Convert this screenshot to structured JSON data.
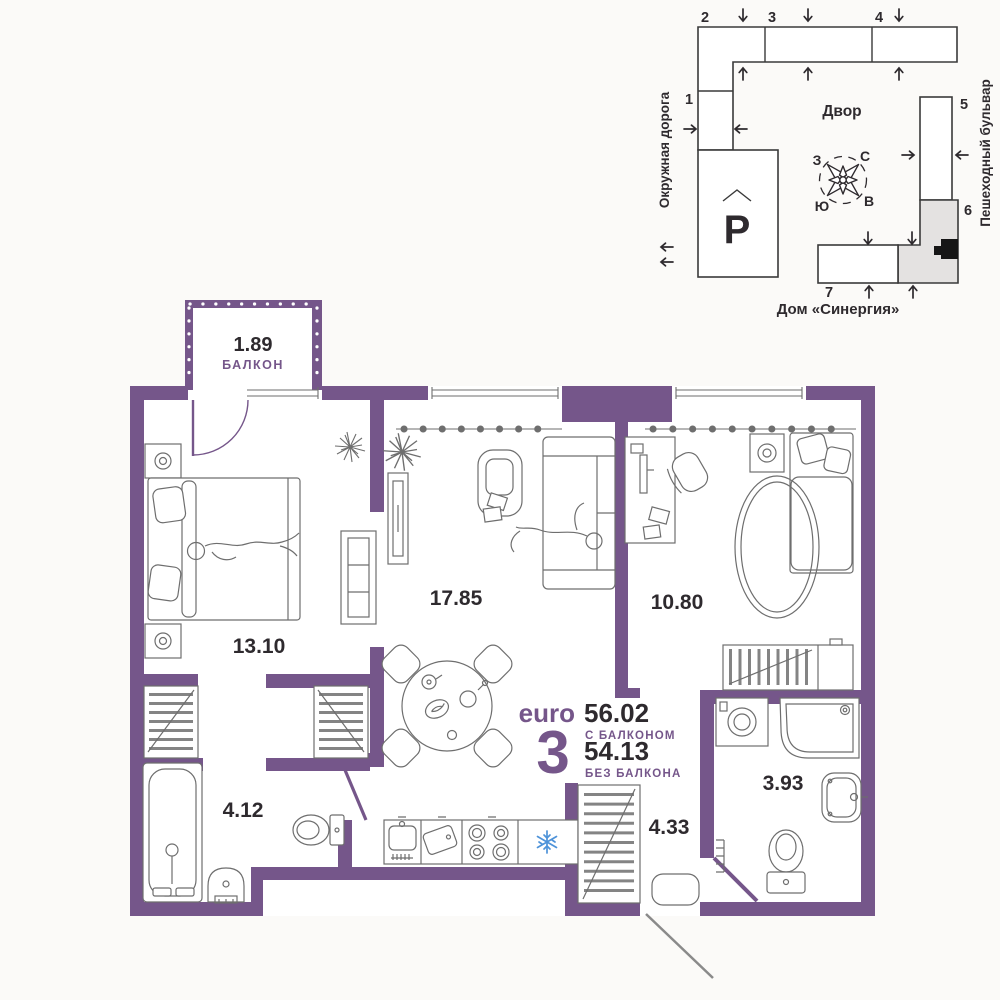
{
  "plan": {
    "balcony": {
      "area": "1.89",
      "label": "БАЛКОН"
    },
    "rooms": [
      {
        "id": "bedroom",
        "area": "13.10"
      },
      {
        "id": "living-kitchen",
        "area": "17.85"
      },
      {
        "id": "kids-room",
        "area": "10.80"
      },
      {
        "id": "bathroom-large",
        "area": "4.12"
      },
      {
        "id": "hallway",
        "area": "4.33"
      },
      {
        "id": "bathroom-small",
        "area": "3.93"
      }
    ],
    "summary": {
      "type_prefix": "euro",
      "rooms_count": "3",
      "area_with_balcony": "56.02",
      "with_balcony_label": "С БАЛКОНОМ",
      "area_without_balcony": "54.13",
      "without_balcony_label": "БЕЗ БАЛКОНА"
    }
  },
  "site_plan": {
    "courtyard_label": "Двор",
    "building_name": "Дом «Синергия»",
    "street_left": "Окружная дорога",
    "street_right": "Пешеходный бульвар",
    "parking_label": "P",
    "sections": [
      "1",
      "2",
      "3",
      "4",
      "5",
      "6",
      "7"
    ],
    "compass": {
      "north": "С",
      "south": "Ю",
      "west": "З",
      "east": "В"
    }
  },
  "colors": {
    "wall": "#75568A",
    "accent_text": "#75568A",
    "dark_text": "#2E2A2E",
    "site_outline": "#3A3A3A",
    "highlighted_section": "#E4E2E1",
    "snowflake_blue": "#4E93D9",
    "entry_door_line": "#8A8A8A"
  }
}
